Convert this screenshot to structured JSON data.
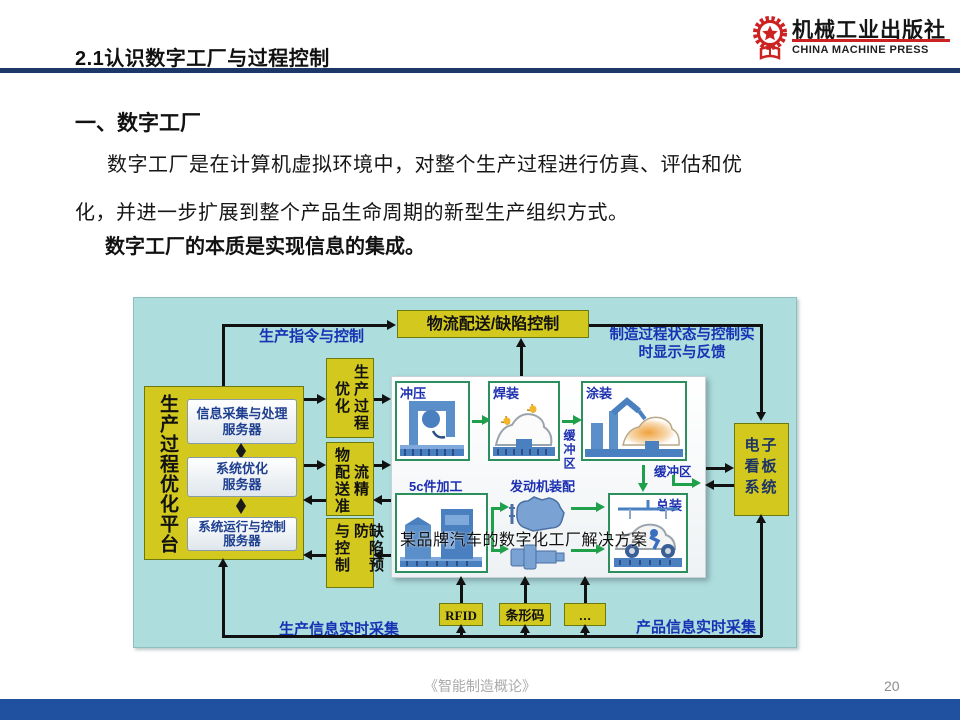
{
  "header": {
    "title": "2.1认识数字工厂与过程控制",
    "logo_cn": "机械工业出版社",
    "logo_en": "CHINA MACHINE PRESS"
  },
  "body": {
    "heading": "一、数字工厂",
    "para_line1": "数字工厂是在计算机虚拟环境中，对整个生产过程进行仿真、评估和优",
    "para_line2": "化，并进一步扩展到整个产品生命周期的新型生产组织方式。",
    "emphasis": "数字工厂的本质是实现信息的集成。"
  },
  "diagram": {
    "caption": "某品牌汽车的数字化工厂解决方案",
    "top_box": "物流配送/缺陷控制",
    "label_production_command": "生产指令与控制",
    "label_status_line1": "制造过程状态与控制实",
    "label_status_line2": "时显示与反馈",
    "platform_label": "生产过程优化平台",
    "server1_line1": "信息采集与处理",
    "server1_line2": "服务器",
    "server2_line1": "系统优化",
    "server2_line2": "服务器",
    "server3_line1": "系统运行与控制",
    "server3_line2": "服务器",
    "mid1_left": "优化",
    "mid1_right": "生产过程",
    "mid2_left": "物配送准",
    "mid2_right": "流精",
    "mid3_left": "与控制",
    "mid3_right": "缺陷预防",
    "kanban": "电子看板系统",
    "station_stamping": "冲压",
    "station_welding": "焊装",
    "station_painting": "涂装",
    "station_machining": "5c件加工",
    "station_engine": "发动机装配",
    "station_assembly": "总装",
    "buffer_vertical": "缓冲区",
    "buffer_horizontal": "缓冲区",
    "rfid": "RFID",
    "barcode": "条形码",
    "more": "…",
    "label_prod_info": "生产信息实时采集",
    "label_product_info": "产品信息实时采集"
  },
  "footer": {
    "book": "《智能制造概论》",
    "page": "20"
  },
  "colors": {
    "header_rule_navy": "#1c3866",
    "bottom_bar_blue": "#2050a0",
    "diagram_teal": "#aedddd",
    "box_yellow": "#d2c81e",
    "flow_label_blue": "#1733b5",
    "process_green": "#1fa04a",
    "logo_red": "#cc2222"
  }
}
